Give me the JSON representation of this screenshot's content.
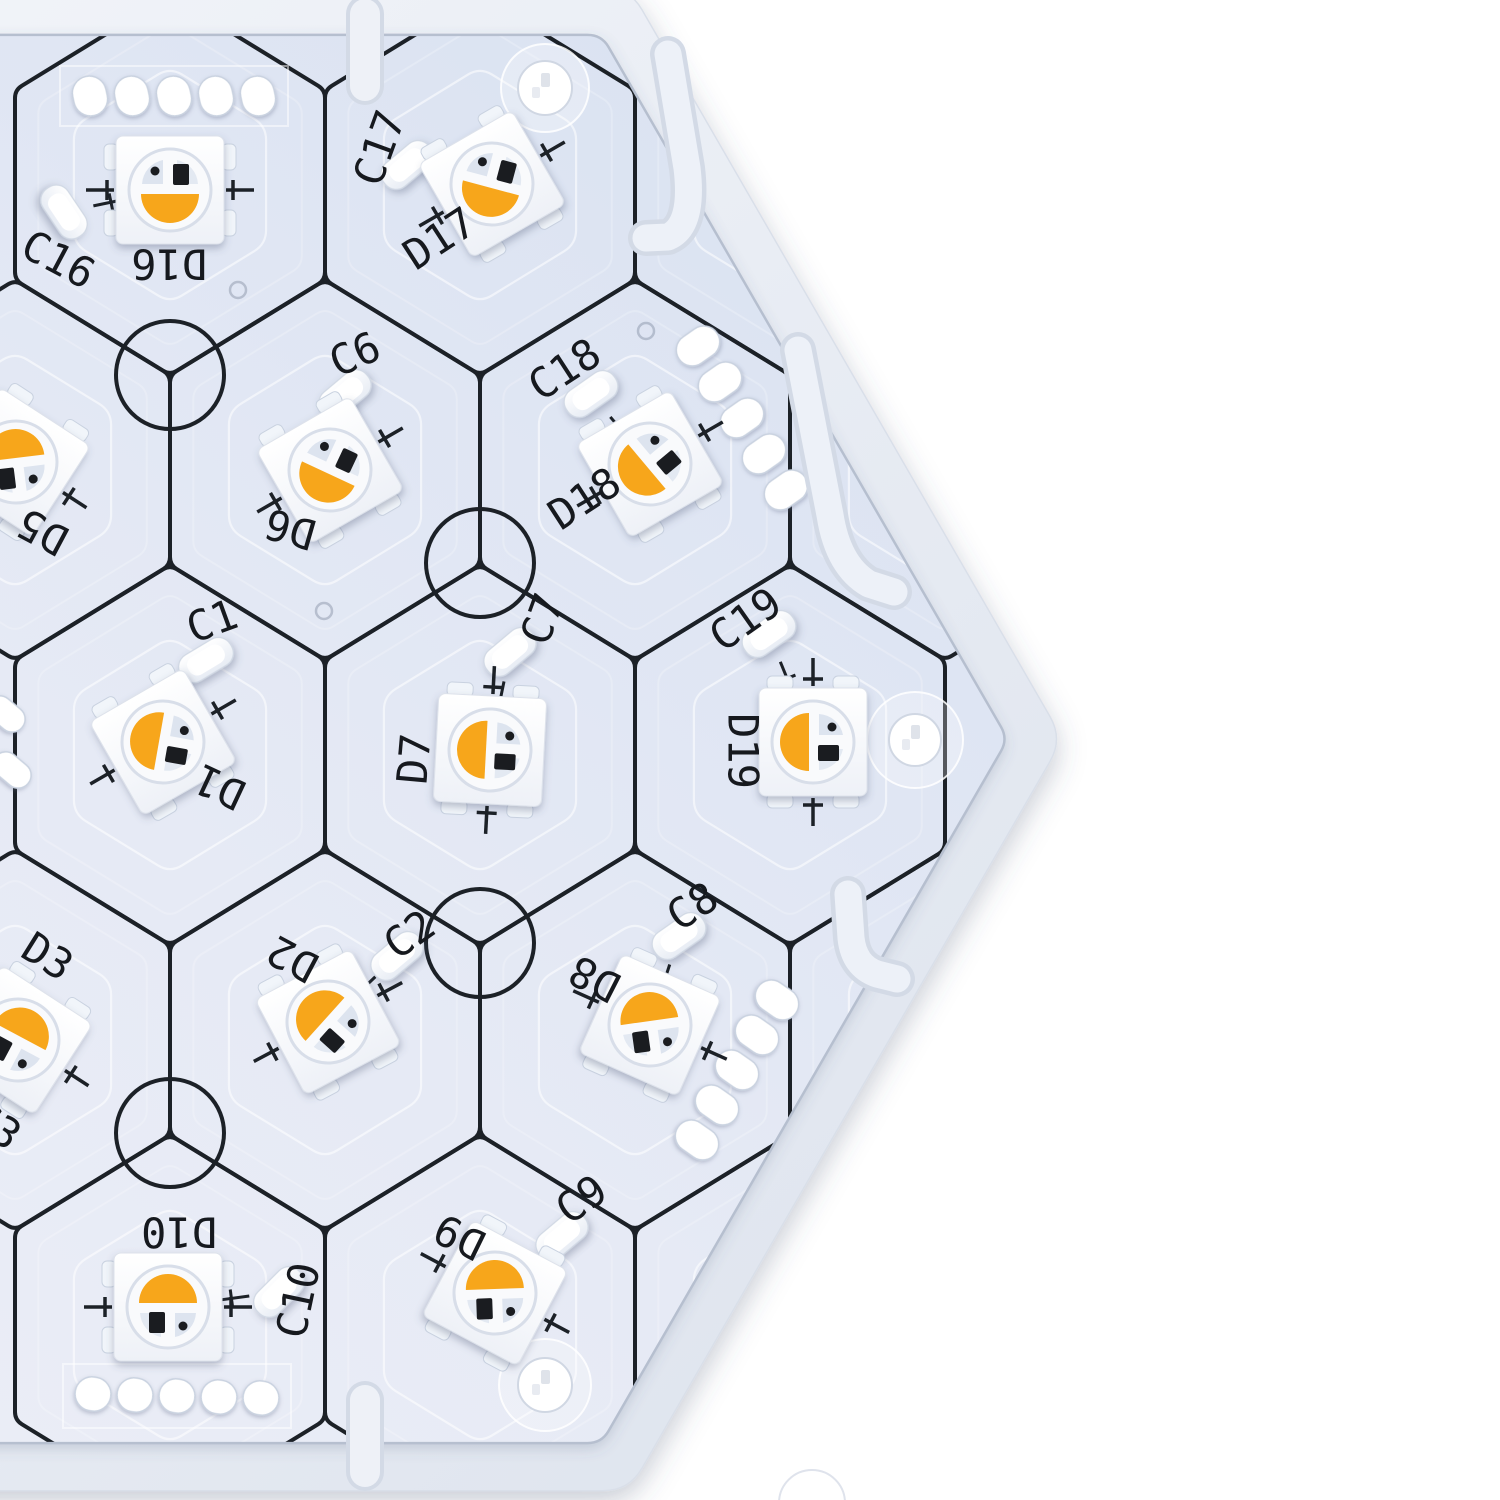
{
  "meta": {
    "description_colors": {
      "background": "#ffffff",
      "frame_light": "#f5f7fb",
      "frame_dark": "#dde3ed",
      "pcb_top": "#d8e1f1",
      "pcb_mid": "#e6eaf5",
      "pcb_bottom": "#edeff7",
      "silk_line": "#1c2127",
      "label_ink": "#16191e",
      "led_orange": "#f7a61b",
      "pad_white": "#ffffff"
    }
  },
  "board": {
    "cx": 195,
    "cy": 739,
    "a_pcb": 813,
    "a_frame": 868,
    "corner_pcb": 14,
    "corner_frame": 26,
    "cell_w": 310,
    "cell_s": 190,
    "line_width": 4
  },
  "cells": [
    [
      170,
      185
    ],
    [
      480,
      185
    ],
    [
      790,
      185
    ],
    [
      15,
      470
    ],
    [
      325,
      470
    ],
    [
      635,
      470
    ],
    [
      945,
      470
    ],
    [
      170,
      755
    ],
    [
      480,
      755
    ],
    [
      790,
      755
    ],
    [
      15,
      1040
    ],
    [
      325,
      1040
    ],
    [
      635,
      1040
    ],
    [
      945,
      1040
    ],
    [
      170,
      1325
    ],
    [
      480,
      1325
    ],
    [
      790,
      1325
    ]
  ],
  "fiducials": {
    "r": 54,
    "centers": [
      [
        170,
        375
      ],
      [
        480,
        563
      ],
      [
        480,
        943
      ],
      [
        170,
        1133
      ]
    ]
  },
  "vias": [
    [
      238,
      290
    ],
    [
      324,
      611
    ],
    [
      758,
      452
    ],
    [
      646,
      331
    ]
  ],
  "screw_holes": [
    {
      "x": 545,
      "y": 88,
      "r": 27,
      "ring": 44
    },
    {
      "x": 915,
      "y": 740,
      "r": 26,
      "ring": 48
    },
    {
      "x": 545,
      "y": 1385,
      "r": 27,
      "ring": 46
    }
  ],
  "frame_hole": {
    "x": 812,
    "y": 1503,
    "r": 33
  },
  "slots": [
    {
      "x": 365,
      "y1": 14,
      "y2": 86
    },
    {
      "x": 365,
      "y1": 1400,
      "y2": 1472
    }
  ],
  "hooks": [
    {
      "d": "M 668 54 L 687 168 Q 694 226 668 237 L 646 238"
    },
    {
      "d": "M 798 350 L 830 515 Q 838 566 869 584 L 894 592"
    },
    {
      "d": "M 848 894 L 851 938 Q 854 966 877 974 L 897 979"
    }
  ],
  "pad_groups": [
    {
      "x0": 90,
      "y0": 96,
      "dx": 42,
      "dy": 0,
      "n": 5,
      "w": 34,
      "h": 40,
      "rot": -12,
      "outline": true
    },
    {
      "x0": 93,
      "y0": 1394,
      "dx": 42,
      "dy": 1,
      "n": 5,
      "w": 36,
      "h": 34,
      "rot": 10,
      "outline": true
    },
    {
      "x0": 698,
      "y0": 346,
      "dx": 22,
      "dy": 36,
      "n": 5,
      "w": 46,
      "h": 32,
      "rot": -35,
      "outline": false
    },
    {
      "x0": 777,
      "y0": 1000,
      "dx": -20,
      "dy": 35,
      "n": 5,
      "w": 46,
      "h": 32,
      "rot": 35,
      "outline": false
    },
    {
      "x0": 6,
      "y0": 714,
      "dx": 6,
      "dy": 56,
      "n": 2,
      "w": 42,
      "h": 26,
      "rot": 40,
      "outline": false
    }
  ],
  "leds": [
    {
      "id": "D16",
      "x": 170,
      "y": 190,
      "rot": 0,
      "lens": 0,
      "nub": 0,
      "marks": "h",
      "label": {
        "t": "D16",
        "x": 169,
        "y": 261,
        "r": 180
      }
    },
    {
      "id": "D17",
      "x": 492,
      "y": 184,
      "rot": -30,
      "lens": 45,
      "nub": 90,
      "marks": "h",
      "label": {
        "t": "D17",
        "x": 441,
        "y": 241,
        "r": -33
      }
    },
    {
      "id": "D5",
      "x": 16,
      "y": 462,
      "rot": 33,
      "lens": 140,
      "nub": 90,
      "marks": "h",
      "label": {
        "t": "D5",
        "x": 44,
        "y": 529,
        "r": 208
      }
    },
    {
      "id": "D6",
      "x": 330,
      "y": 470,
      "rot": -30,
      "lens": 55,
      "nub": 90,
      "marks": "h",
      "label": {
        "t": "D6",
        "x": 291,
        "y": 526,
        "r": 196
      }
    },
    {
      "id": "D18",
      "x": 650,
      "y": 464,
      "rot": -30,
      "lens": 80,
      "nub": 90,
      "marks": "h",
      "label": {
        "t": "D18",
        "x": 586,
        "y": 501,
        "r": -33
      }
    },
    {
      "id": "D1",
      "x": 163,
      "y": 742,
      "rot": -30,
      "lens": 130,
      "nub": 90,
      "marks": "h",
      "label": {
        "t": "D1",
        "x": 221,
        "y": 784,
        "r": 205
      }
    },
    {
      "id": "D7",
      "x": 490,
      "y": 750,
      "rot": 3,
      "lens": 90,
      "nub": 90,
      "marks": "v",
      "label": {
        "t": "D7",
        "x": 417,
        "y": 759,
        "r": -85
      }
    },
    {
      "id": "D19",
      "x": 813,
      "y": 742,
      "rot": 0,
      "lens": 90,
      "nub": 90,
      "marks": "v",
      "label": {
        "t": "D19",
        "x": 740,
        "y": 751,
        "r": 90
      }
    },
    {
      "id": "D2",
      "x": 328,
      "y": 1022,
      "rot": -28,
      "lens": 160,
      "nub": 90,
      "marks": "h",
      "label": {
        "t": "D2",
        "x": 294,
        "y": 956,
        "r": 208
      }
    },
    {
      "id": "D8",
      "x": 650,
      "y": 1025,
      "rot": 24,
      "lens": 148,
      "nub": 90,
      "marks": "h",
      "label": {
        "t": "D8",
        "x": 596,
        "y": 976,
        "r": 207
      }
    },
    {
      "id": "D3",
      "x": 18,
      "y": 1040,
      "rot": 33,
      "lens": 175,
      "nub": 90,
      "marks": "h",
      "label": {
        "t": "D3",
        "x": 46,
        "y": 959,
        "r": 32
      }
    },
    {
      "id": "D10",
      "x": 168,
      "y": 1307,
      "rot": 0,
      "lens": 180,
      "nub": 0,
      "marks": "h",
      "label": {
        "t": "D10",
        "x": 179,
        "y": 1229,
        "r": 180
      }
    },
    {
      "id": "D9",
      "x": 495,
      "y": 1293,
      "rot": 28,
      "lens": 150,
      "nub": 90,
      "marks": "h",
      "label": {
        "t": "D9",
        "x": 461,
        "y": 1234,
        "r": 206
      }
    }
  ],
  "caps": [
    {
      "id": "C16",
      "x": 64,
      "y": 212,
      "rot": 56,
      "led": "D16",
      "label": {
        "t": "C16",
        "x": 57,
        "y": 262,
        "r": 28
      }
    },
    {
      "id": "C17",
      "x": 407,
      "y": 165,
      "rot": -40,
      "led": "D17",
      "label": {
        "t": "C17",
        "x": 382,
        "y": 149,
        "r": -70
      }
    },
    {
      "id": "C6",
      "x": 345,
      "y": 394,
      "rot": -40,
      "led": "D6",
      "label": {
        "t": "C6",
        "x": 356,
        "y": 357,
        "r": -24
      }
    },
    {
      "id": "C18",
      "x": 591,
      "y": 394,
      "rot": -35,
      "led": "D18",
      "label": {
        "t": "C18",
        "x": 566,
        "y": 372,
        "r": -33
      }
    },
    {
      "id": "C1",
      "x": 206,
      "y": 660,
      "rot": -31,
      "led": "D1",
      "label": {
        "t": "C1",
        "x": 213,
        "y": 624,
        "r": -20
      }
    },
    {
      "id": "C7",
      "x": 510,
      "y": 652,
      "rot": -40,
      "led": "D7",
      "label": {
        "t": "C7",
        "x": 545,
        "y": 620,
        "r": -70
      }
    },
    {
      "id": "C19",
      "x": 769,
      "y": 634,
      "rot": -35,
      "led": "D19",
      "label": {
        "t": "C19",
        "x": 747,
        "y": 622,
        "r": -35
      }
    },
    {
      "id": "C2",
      "x": 397,
      "y": 956,
      "rot": -40,
      "led": "D2",
      "label": {
        "t": "C2",
        "x": 411,
        "y": 937,
        "r": -35
      }
    },
    {
      "id": "C8",
      "x": 679,
      "y": 936,
      "rot": -35,
      "led": "D8",
      "label": {
        "t": "C8",
        "x": 694,
        "y": 909,
        "r": -33
      }
    },
    {
      "id": "C10",
      "x": 279,
      "y": 1292,
      "rot": -45,
      "led": "D10",
      "label": {
        "t": "C10",
        "x": 301,
        "y": 1301,
        "r": -78
      }
    },
    {
      "id": "C9",
      "x": 562,
      "y": 1236,
      "rot": -40,
      "led": "D9",
      "label": {
        "t": "C9",
        "x": 583,
        "y": 1202,
        "r": -35
      }
    }
  ],
  "extra_labels": [
    {
      "t": "C3",
      "x": -6,
      "y": 1128,
      "r": 35
    }
  ]
}
